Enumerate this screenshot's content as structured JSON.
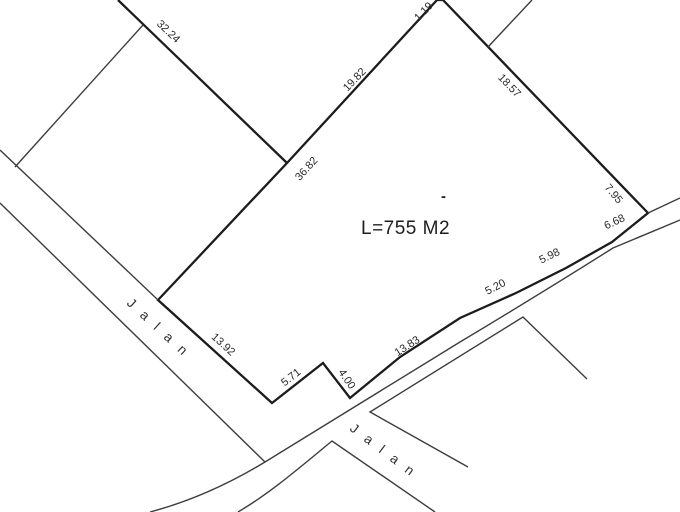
{
  "plan": {
    "title": "land-survey-parcel-plan",
    "area_label": "L=755 M2",
    "tick": "-",
    "colors": {
      "background": "#ffffff",
      "parcel_line": "#1c1c1c",
      "thin_line": "#3d3d3d",
      "label_text": "#2a2a2a"
    }
  },
  "dimensions": {
    "nw_upper": "32.24",
    "top_bevel": "1.19",
    "nw": "19.82",
    "west": "36.82",
    "ne": "18.57",
    "ne_lower": "7.95",
    "se_1": "6.68",
    "se_2": "5.98",
    "se_3": "5.20",
    "se_4": "13.83",
    "notch_right": "4.00",
    "notch_left": "5.71",
    "sw": "13.92"
  },
  "roads": {
    "northwest_road_label": "Jalan",
    "southeast_road_label": "Jalan"
  }
}
